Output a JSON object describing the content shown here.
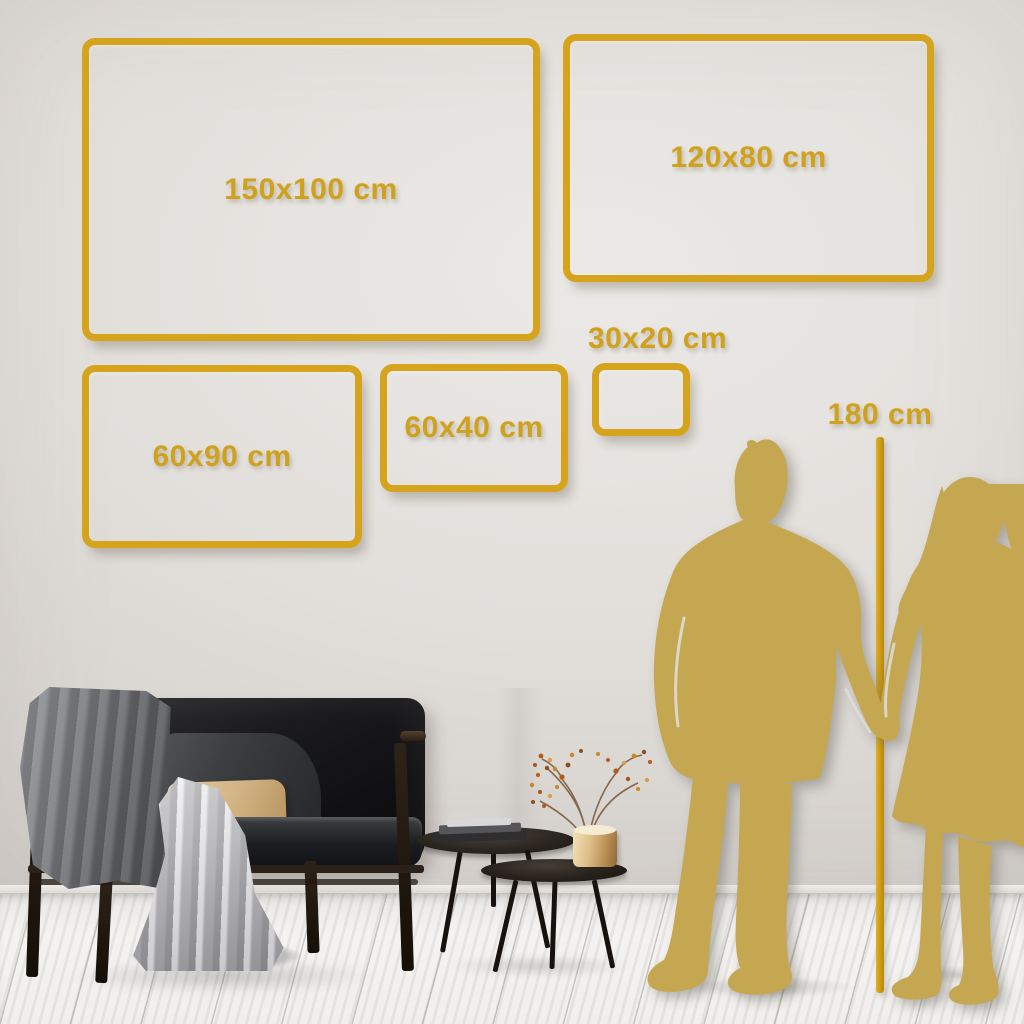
{
  "frames": [
    {
      "label": "150x100 cm"
    },
    {
      "label": "120x80 cm"
    },
    {
      "label": "60x90 cm"
    },
    {
      "label": "60x40 cm"
    },
    {
      "label": "30x20 cm"
    }
  ],
  "height_marker": {
    "label": "180 cm"
  },
  "colors": {
    "frame_gold": "#D5A41C",
    "label_gold": "#D0A11D",
    "line_gold": "#CB9A10",
    "silhouette_gold": "#C6A751",
    "wall": "#E2DFDB",
    "floor": "#F2F1EF"
  }
}
